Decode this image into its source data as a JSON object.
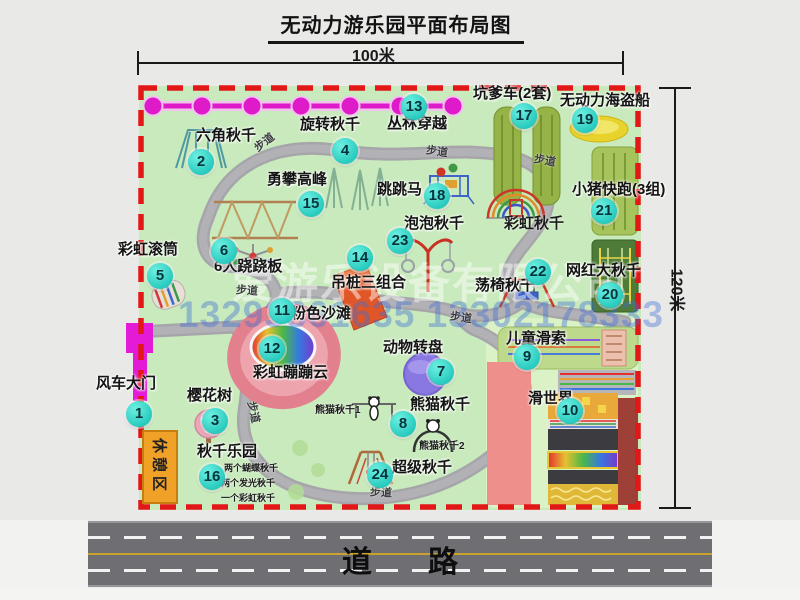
{
  "title": "无动力游乐园平面布局图",
  "dimension_labels": {
    "top": "100米",
    "right": "120米"
  },
  "road": {
    "label": "道路"
  },
  "rest_area": {
    "label": "休憩区"
  },
  "watermark": {
    "company": "爱游乐设备有限公司",
    "phone": "13293861635 13302178333"
  },
  "colors": {
    "park_green": "#c9eabd",
    "path_gray": "#a6a6aa",
    "border_red": "#e21717",
    "marker_cyan": "#27cabe",
    "zipline_magenta": "#df1ac9",
    "gate_magenta": "#e31ad6",
    "rest_orange": "#f0a128",
    "road_gray": "#6e6e73"
  },
  "attractions": [
    {
      "num": 1,
      "name": "风车大门",
      "marker": {
        "x": 139,
        "y": 414
      },
      "label": {
        "x": 96,
        "y": 376
      }
    },
    {
      "num": 2,
      "name": "六角秋千",
      "marker": {
        "x": 201,
        "y": 162
      },
      "label": {
        "x": 196,
        "y": 128
      }
    },
    {
      "num": 3,
      "name": "樱花树",
      "marker": {
        "x": 215,
        "y": 421
      },
      "label": {
        "x": 187,
        "y": 388
      }
    },
    {
      "num": 4,
      "name": "旋转秋千",
      "marker": {
        "x": 345,
        "y": 151
      },
      "label": {
        "x": 300,
        "y": 117
      }
    },
    {
      "num": 5,
      "name": "彩虹滚筒",
      "marker": {
        "x": 160,
        "y": 276
      },
      "label": {
        "x": 118,
        "y": 242
      }
    },
    {
      "num": 6,
      "name": "6人跷跷板",
      "marker": {
        "x": 224,
        "y": 251
      },
      "label": {
        "x": 214,
        "y": 259
      }
    },
    {
      "num": 7,
      "name": "动物转盘",
      "marker": {
        "x": 441,
        "y": 372
      },
      "label": {
        "x": 383,
        "y": 340
      }
    },
    {
      "num": 8,
      "name": "熊猫秋千",
      "marker": {
        "x": 403,
        "y": 424
      },
      "label": {
        "x": 410,
        "y": 397
      }
    },
    {
      "num": 9,
      "name": "儿童滑索",
      "marker": {
        "x": 527,
        "y": 357
      },
      "label": {
        "x": 506,
        "y": 331
      }
    },
    {
      "num": 10,
      "name": "滑世界",
      "marker": {
        "x": 570,
        "y": 411
      },
      "label": {
        "x": 528,
        "y": 391
      }
    },
    {
      "num": 11,
      "name": "粉色沙滩",
      "marker": {
        "x": 282,
        "y": 311
      },
      "label": {
        "x": 291,
        "y": 306
      }
    },
    {
      "num": 12,
      "name": "彩虹蹦蹦云",
      "marker": {
        "x": 272,
        "y": 349
      },
      "label": {
        "x": 253,
        "y": 365
      }
    },
    {
      "num": 13,
      "name": "丛林穿越",
      "marker": {
        "x": 414,
        "y": 107
      },
      "label": {
        "x": 387,
        "y": 116
      }
    },
    {
      "num": 14,
      "name": "吊桩三组合",
      "marker": {
        "x": 360,
        "y": 258
      },
      "label": {
        "x": 331,
        "y": 275
      }
    },
    {
      "num": 15,
      "name": "勇攀高峰",
      "marker": {
        "x": 311,
        "y": 204
      },
      "label": {
        "x": 267,
        "y": 172
      }
    },
    {
      "num": 16,
      "name": "秋千乐园",
      "marker": {
        "x": 212,
        "y": 477
      },
      "label": {
        "x": 197,
        "y": 444
      }
    },
    {
      "num": 17,
      "name": "坑爹车(2套)",
      "marker": {
        "x": 524,
        "y": 116
      },
      "label": {
        "x": 473,
        "y": 86
      }
    },
    {
      "num": 18,
      "name": "跳跳马",
      "marker": {
        "x": 437,
        "y": 196
      },
      "label": {
        "x": 377,
        "y": 182
      }
    },
    {
      "num": 19,
      "name": "无动力海盗船",
      "marker": {
        "x": 585,
        "y": 120
      },
      "label": {
        "x": 560,
        "y": 93
      }
    },
    {
      "num": 20,
      "name": "网红大秋千",
      "marker": {
        "x": 610,
        "y": 295
      },
      "label": {
        "x": 566,
        "y": 263
      }
    },
    {
      "num": 21,
      "name": "小猪快跑(3组)",
      "marker": {
        "x": 604,
        "y": 211
      },
      "label": {
        "x": 572,
        "y": 182
      }
    },
    {
      "num": 22,
      "name": "荡椅秋千",
      "marker": {
        "x": 538,
        "y": 272
      },
      "label": {
        "x": 475,
        "y": 278
      }
    },
    {
      "num": 23,
      "name": "泡泡秋千",
      "marker": {
        "x": 400,
        "y": 241
      },
      "label": {
        "x": 404,
        "y": 216
      }
    },
    {
      "num": 24,
      "name": "超级秋千",
      "marker": {
        "x": 380,
        "y": 475
      },
      "label": {
        "x": 392,
        "y": 460
      }
    }
  ],
  "extra_labels": [
    {
      "text": "彩虹秋千",
      "x": 504,
      "y": 212,
      "size": 15
    },
    {
      "text": "熊猫秋千1",
      "x": 315,
      "y": 401,
      "size": 10
    },
    {
      "text": "熊猫秋千2",
      "x": 419,
      "y": 437,
      "size": 10
    },
    {
      "text": "两个蝴蝶秋千",
      "x": 224,
      "y": 461,
      "size": 9
    },
    {
      "text": "两个发光秋千",
      "x": 221,
      "y": 476,
      "size": 9
    },
    {
      "text": "一个彩虹秋千",
      "x": 221,
      "y": 491,
      "size": 9
    }
  ],
  "path_labels": [
    {
      "text": "步道",
      "x": 253,
      "y": 134,
      "rot": -38
    },
    {
      "text": "步道",
      "x": 426,
      "y": 143,
      "rot": 8
    },
    {
      "text": "步道",
      "x": 534,
      "y": 152,
      "rot": 10
    },
    {
      "text": "步道",
      "x": 236,
      "y": 282,
      "rot": 4
    },
    {
      "text": "步道",
      "x": 243,
      "y": 404,
      "rot": 78
    },
    {
      "text": "步道",
      "x": 450,
      "y": 309,
      "rot": 8
    },
    {
      "text": "步道",
      "x": 370,
      "y": 484,
      "rot": 3
    }
  ]
}
